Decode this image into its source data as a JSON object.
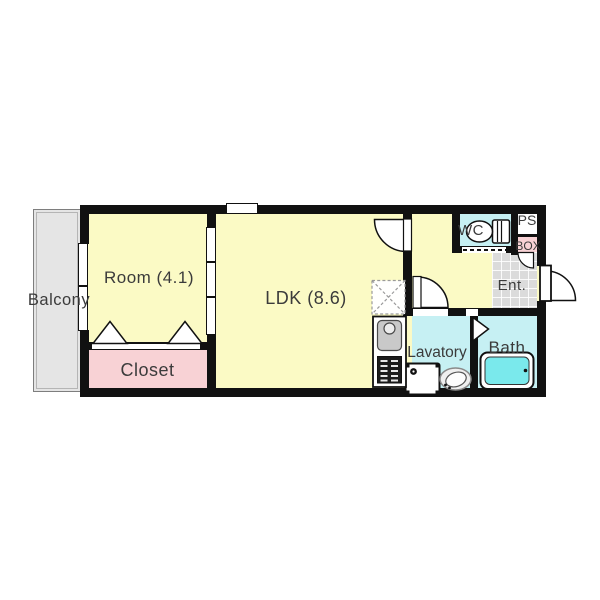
{
  "floorplan": {
    "rooms": {
      "balcony": {
        "label": "Balcony"
      },
      "room": {
        "label": "Room (4.1)",
        "area": "4.1"
      },
      "ldk": {
        "label": "LDK (8.6)",
        "area": "8.6"
      },
      "closet": {
        "label": "Closet"
      },
      "wc": {
        "label": "WC"
      },
      "ps": {
        "label": "PS"
      },
      "box": {
        "label": "BOX"
      },
      "entrance": {
        "label": "Ent."
      },
      "lavatory": {
        "label": "Lavatory"
      },
      "bath": {
        "label": "Bath"
      }
    },
    "icons": [
      "toilet-icon",
      "bathtub-icon",
      "washing-machine-icon",
      "lavatory-sink-icon",
      "kitchen-sink-icon",
      "stove-icon",
      "refrigerator-space-icon",
      "entrance-door-swing-icon",
      "ldk-door-swing-icon",
      "lavatory-door-swing-icon",
      "box-door-swing-icon",
      "bath-folding-door-icon",
      "closet-folding-door-icon",
      "sliding-window-icon",
      "wc-sliding-door-icon"
    ],
    "colors": {
      "wall": "#111111",
      "living_fill": "#FBFAC5",
      "closet_fill": "#F8D2D5",
      "wet_area_fill": "#C6F0F3",
      "bathtub_fill": "#7AE9EC",
      "balcony_fill": "#E5E5E5",
      "entrance_tile_fill": "#DBDBDB",
      "label_text": "#3B3B3B"
    }
  }
}
